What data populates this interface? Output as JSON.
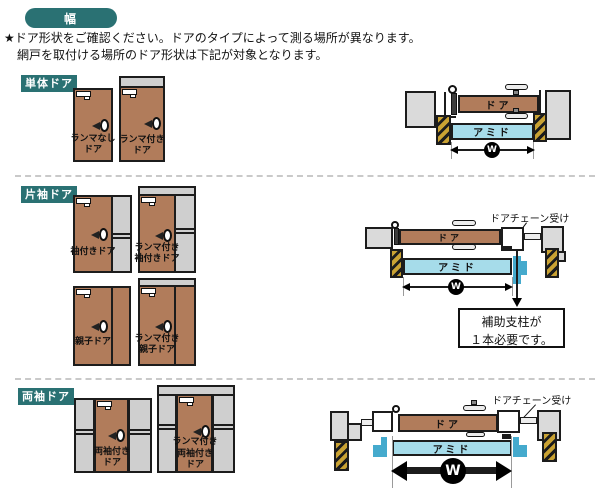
{
  "header": {
    "badge": "幅",
    "line1": "★ドア形状をご確認ください。ドアのタイプによって測る場所が異なります。",
    "line2": "網戸を取付ける場所のドア形状は下記が対象となります。"
  },
  "sections": {
    "single": {
      "label": "単体ドア",
      "doors": [
        "ランマなし\nドア",
        "ランマ付き\nドア"
      ]
    },
    "one_sleeve": {
      "label": "片袖ドア",
      "doors": [
        "袖付きドア",
        "ランマ付き\n袖付きドア",
        "親子ドア",
        "ランマ付き\n親子ドア"
      ]
    },
    "two_sleeve": {
      "label": "両袖ドア",
      "doors": [
        "両袖付き\nドア",
        "ランマ付き\n両袖付き\nドア"
      ]
    }
  },
  "diagrams": {
    "door_label": "ドア",
    "screen_label": "アミド",
    "width_mark": "W",
    "chain_receiver_label": "ドアチェーン受け",
    "support_note": "補助支柱が\n１本必要です。"
  },
  "colors": {
    "accent_teal": "#2a7173",
    "door_brown": "#b17c5b",
    "panel_gray": "#cfcfcf",
    "wall_gray": "#dadada",
    "screen_cyan": "#a6dcea",
    "support_blue": "#45aacd",
    "frame_hatch_yellow": "#c9a233"
  }
}
